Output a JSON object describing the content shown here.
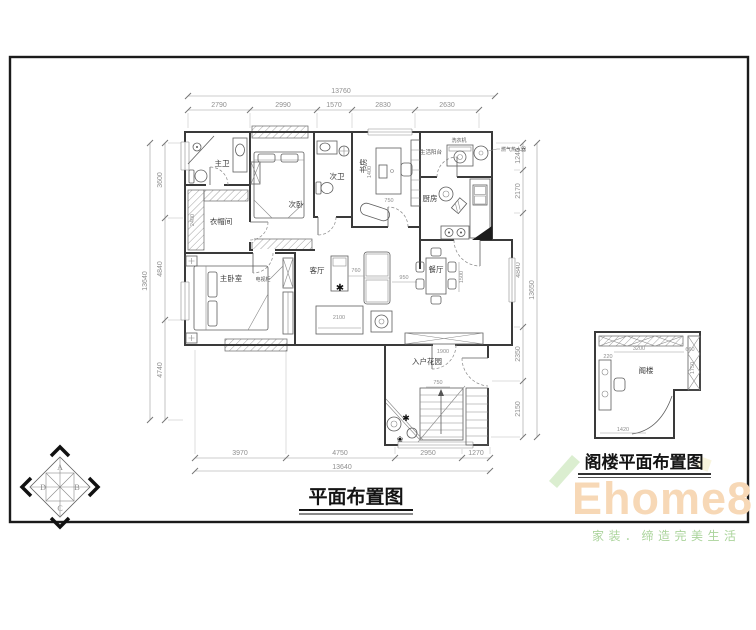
{
  "titles": {
    "main": "平面布置图",
    "attic": "阁楼平面布置图"
  },
  "rooms": {
    "master_bath": "主卫",
    "closet": "衣帽间",
    "second_bedroom": "次卧",
    "second_bath": "次卫",
    "study": "书房",
    "service_balcony": "生活阳台",
    "kitchen": "厨房",
    "master_bedroom": "主卧室",
    "living_room": "客厅",
    "dining_room": "餐厅",
    "entry_garden": "入户花园",
    "attic": "阁楼"
  },
  "annotations": {
    "washer": "洗衣机",
    "water_heater": "燃气热水器",
    "tv_cabinet": "电视柜"
  },
  "dims": {
    "top_total": "13760",
    "top": [
      "2790",
      "2990",
      "1570",
      "2830",
      "2630"
    ],
    "bottom": [
      "3970",
      "4750",
      "2950",
      "1270"
    ],
    "bottom_total": "13640",
    "left": [
      "3600",
      "4840",
      "4740"
    ],
    "left_total": "13640",
    "right": [
      "1240",
      "2170",
      "4840",
      "2350",
      "2150"
    ],
    "right_total": "13650",
    "interior": {
      "closet_depth": "2400",
      "study_desk_len": "1400",
      "study_desk_wid": "750",
      "tv_width": "2100",
      "living_gap": "760",
      "sofa_dining_gap": "950",
      "dining_len": "1500",
      "shoe_cabinet": "1900",
      "stair_width": "750"
    },
    "attic": {
      "top": "3200",
      "top_right": "660",
      "desk": "220",
      "right_h": "1750",
      "bottom": "1420"
    }
  },
  "compass": {
    "n": "A",
    "e": "B",
    "s": "C",
    "w": "D"
  },
  "watermark": {
    "brand": "Ehome8",
    "tagline": "家装．缔造完美生活"
  },
  "icons": {
    "plant": "✱",
    "flower": "❀"
  },
  "colors": {
    "wall": "#3a3a3a",
    "dimension": "#8f8f8f",
    "brand": "#f7d8b6",
    "tagline": "#abd49c",
    "ribbon_green": "#cfe8c0"
  }
}
